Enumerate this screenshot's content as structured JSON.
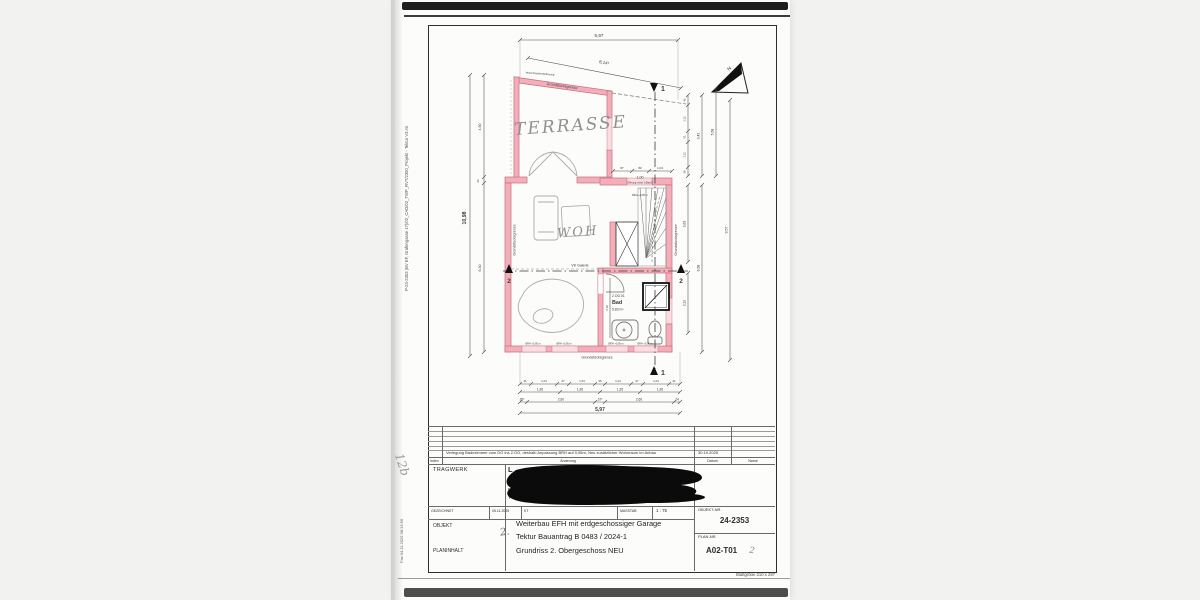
{
  "margin": {
    "file_path": "P-24-2353 (BV EF, Grafengasse 17)/02_CAD/02_TWP_RVT/2350_Projekt - Tektur V3.rvt",
    "fax_stamp": "Fax 04.11.2025 08:13:56",
    "handwritten_mark": "12b",
    "sheet_size": "Blattgröße 210 x 297"
  },
  "plan": {
    "rooms": {
      "terrasse": "TERRASSE",
      "wohnen": "WOH",
      "bad_id": "2.OG.01",
      "bad_name": "Bad",
      "bad_area": "5,83 m²"
    },
    "boundary_label": "Grundstücksgrenze",
    "notes": {
      "vk_galerie": "VK Galerie",
      "neighbor_wall": "Wand Nachbarbebauung",
      "opening_dim": "1,00",
      "opening_note": "Öffnung mind. lt.BauO",
      "brh": "BRH +0,95 m",
      "north": "N"
    },
    "section1": "1",
    "section2": "2",
    "dims": {
      "top_total": "5,97",
      "top_slant": "8,14⁵",
      "left_total": "10,98",
      "left_upper": "4,50",
      "left_wall": "20",
      "left_lower": "6,30",
      "stair_row": [
        "87",
        "80",
        "1,04"
      ],
      "right_chain": [
        "46",
        "1,12",
        "51",
        "1,12",
        "38"
      ],
      "right_342": "3,42",
      "right_558": "5,58",
      "right_363": "3,63",
      "right_219": "2,19",
      "right_658": "6,58",
      "right_957": "9,57",
      "bad_219": "2,19",
      "bottom_row1": [
        "41",
        "1,01",
        "47",
        "1,01",
        "35",
        "1,01",
        "47",
        "1,01",
        "41"
      ],
      "bottom_row2": [
        "1,36",
        "1,36",
        "1,35",
        "1,36"
      ],
      "bottom_row3": [
        "28⁵",
        "2,60",
        "37⁵",
        "2,66",
        "24"
      ],
      "bottom_total": "5,97"
    }
  },
  "titleblock": {
    "revision_entry": "Verlegung Badezimmer vom DG ins 2.OG, deshalb Anpassung BRH auf 0,95m, Neu zusätzlicher Wohnraum im Anbau",
    "revision_date": "30.10.2025",
    "col_index": "Index",
    "col_change": "Änderung",
    "col_date": "Datum",
    "col_name": "Name",
    "tragwerk_label": "TRAGWERK",
    "redacted_l1": "L",
    "redacted_l2": "In",
    "redacted_l3": "R",
    "redacted_l4": "T",
    "gezeichnet_label": "GEZEICHNET",
    "gezeichnet_date": "05.11.2025",
    "gezeichnet_by": "KT",
    "massstab_label": "MASSTAB",
    "massstab_value": "1 : 75",
    "objekt_label": "OBJEKT",
    "objekt_line1": "Weiterbau EFH mit erdgeschossiger Garage",
    "objekt_line2": "Tektur Bauantrag B 0483 / 2024-1",
    "objekt_handwritten": "2.",
    "planinhalt_label": "PLANINHALT",
    "planinhalt_value": "Grundriss 2. Obergeschoss NEU",
    "objekt_nr_label": "OBJEKT-NR.",
    "objekt_nr_value": "24-2353",
    "plan_nr_label": "PLAN-NR.",
    "plan_nr_value": "A02-T01",
    "plan_nr_handwritten": "2"
  }
}
